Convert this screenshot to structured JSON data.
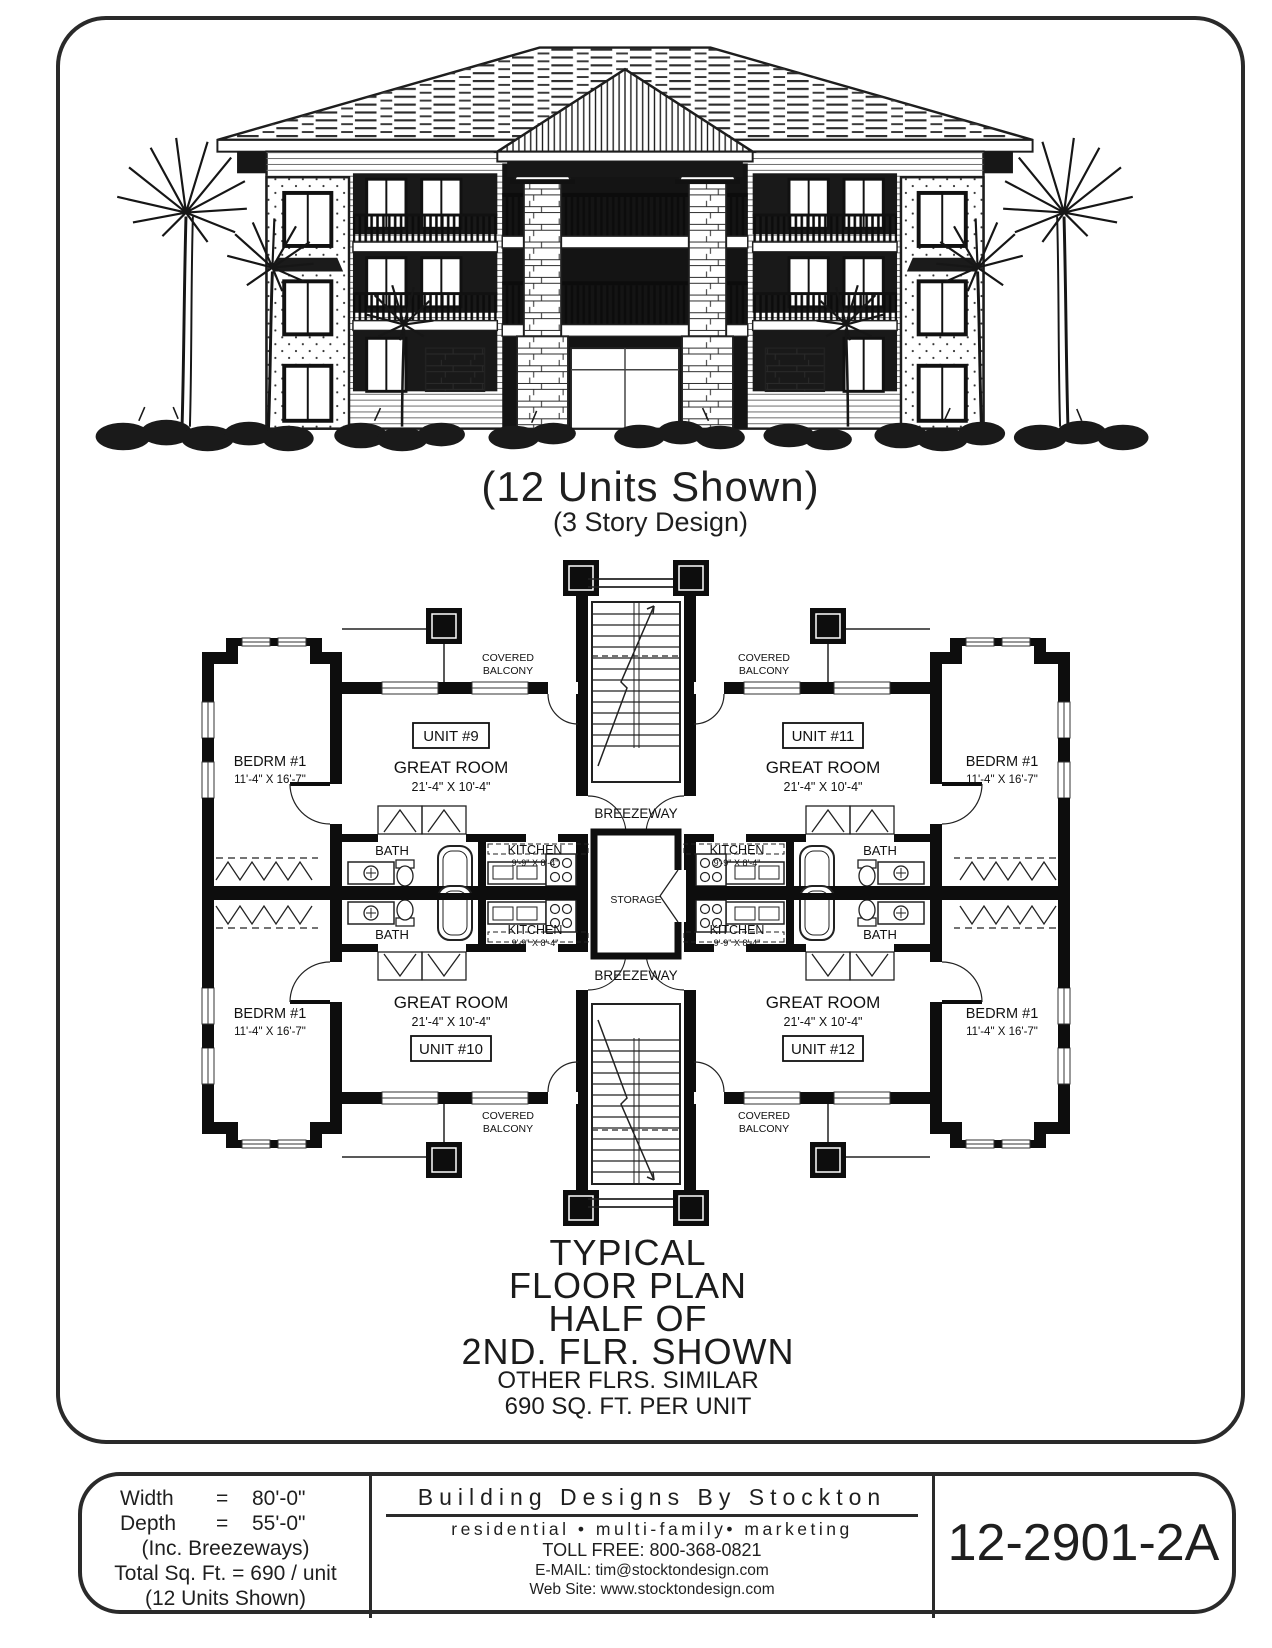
{
  "colors": {
    "ink": "#1f1f1f",
    "paper": "#ffffff"
  },
  "elevation": {
    "caption_main": "(12 Units Shown)",
    "caption_sub": "(3 Story Design)"
  },
  "plan": {
    "covered_balcony": {
      "line1": "COVERED",
      "line2": "BALCONY"
    },
    "breezeway": "BREEZEWAY",
    "storage": "STORAGE",
    "units": {
      "u9": "UNIT #9",
      "u10": "UNIT #10",
      "u11": "UNIT #11",
      "u12": "UNIT #12"
    },
    "great_room": {
      "label": "GREAT ROOM",
      "dims": "21'-4\" X 10'-4\""
    },
    "bedroom": {
      "label": "BEDRM #1",
      "dims": "11'-4\" X 16'-7\""
    },
    "bath": "BATH",
    "kitchen": {
      "label": "KITCHEN",
      "dims": "9'-9\" X 8'-4\""
    }
  },
  "caption": {
    "line1": "TYPICAL",
    "line2": "FLOOR PLAN",
    "line3": "HALF OF",
    "line4": "2ND. FLR. SHOWN",
    "line5": "OTHER FLRS. SIMILAR",
    "line6": "690 SQ. FT. PER UNIT"
  },
  "title_block": {
    "specs": {
      "width_label": "Width",
      "width_eq": "=",
      "width_value": "80'-0\"",
      "depth_label": "Depth",
      "depth_eq": "=",
      "depth_value": "55'-0\"",
      "breezeways_note": "(Inc. Breezeways)",
      "total_line": "Total Sq. Ft. = 690 / unit",
      "units_note": "(12 Units Shown)"
    },
    "company": {
      "name": "Building Designs By Stockton",
      "tagline": "residential • multi-family• marketing",
      "toll_free": "TOLL FREE:  800-368-0821",
      "email_label": "E-MAIL:",
      "email_value": "tim@stocktondesign.com",
      "web_label": "Web Site:",
      "web_value": "www.stocktondesign.com"
    },
    "plan_number": "12-2901-2A"
  }
}
